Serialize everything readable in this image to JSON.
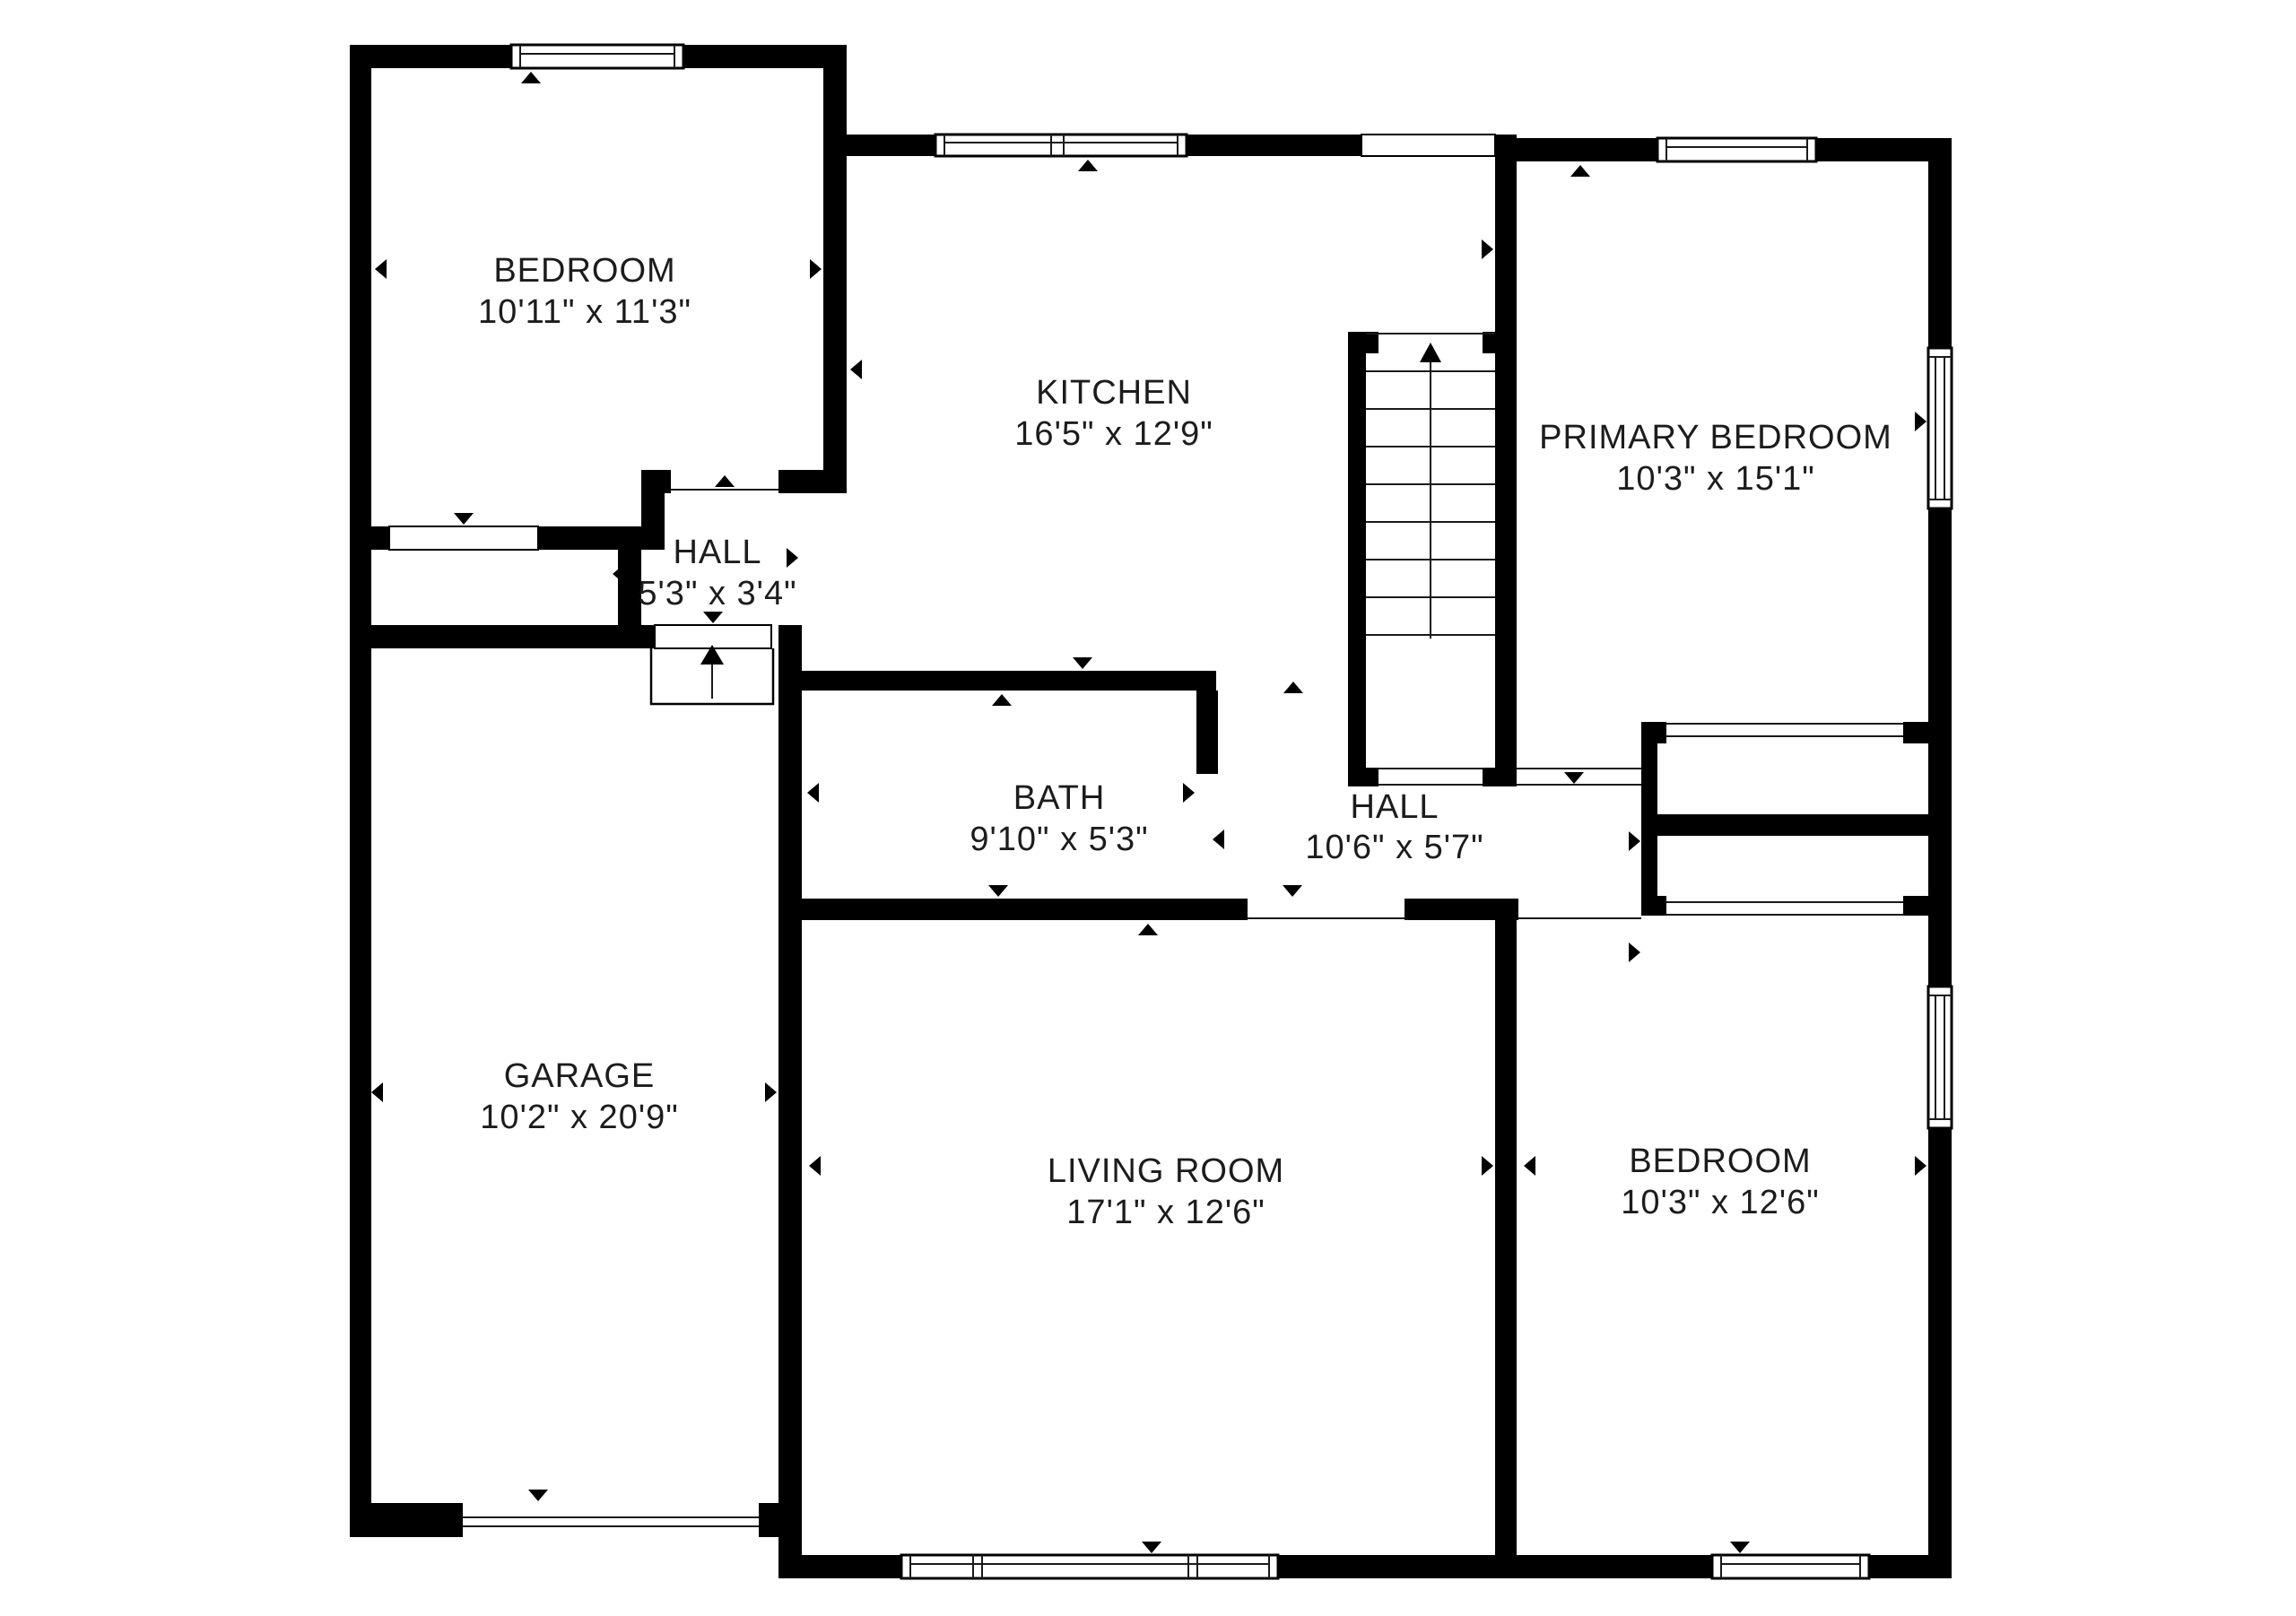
{
  "title": "First floor plan",
  "colors": {
    "wall": "#000000",
    "background": "#ffffff",
    "text": "#1c1c1c"
  },
  "icons": {
    "stairs-up-arrow": "↑",
    "entry-up-arrow": "↑",
    "door-marker-icon": "▲",
    "window-marker-icon": "▲"
  },
  "rooms": [
    {
      "name": "BEDROOM",
      "dims": "10'11\" x 11'3\""
    },
    {
      "name": "KITCHEN",
      "dims": "16'5\" x 12'9\""
    },
    {
      "name": "PRIMARY BEDROOM",
      "dims": "10'3\" x 15'1\""
    },
    {
      "name": "HALL",
      "dims": "5'3\" x 3'4\""
    },
    {
      "name": "BATH",
      "dims": "9'10\" x 5'3\""
    },
    {
      "name": "HALL",
      "dims": "10'6\" x 5'7\""
    },
    {
      "name": "GARAGE",
      "dims": "10'2\" x 20'9\""
    },
    {
      "name": "LIVING ROOM",
      "dims": "17'1\" x 12'6\""
    },
    {
      "name": "BEDROOM",
      "dims": "10'3\" x 12'6\""
    }
  ]
}
